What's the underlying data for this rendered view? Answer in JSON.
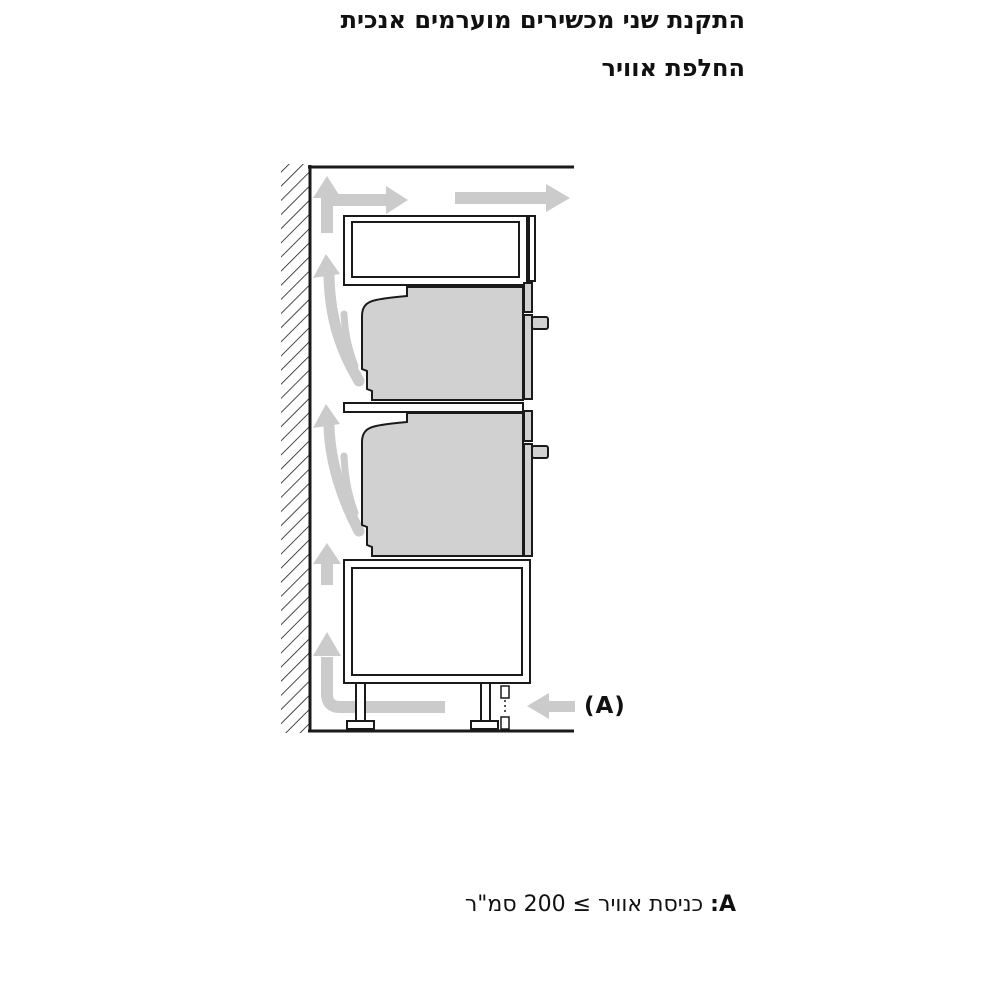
{
  "header": {
    "title": "התקנת שני מכשירים מוערמים אנכית",
    "subtitle": "החלפת אוויר"
  },
  "diagram": {
    "label_a": "(A)",
    "colors": {
      "line": "#1a1a1a",
      "appliance_fill": "#d1d1d1",
      "arrow_fill": "#cbcbcb",
      "background": "#ffffff"
    }
  },
  "footnote": {
    "prefix": "A:",
    "text": " כניסת אוויר ≥ 200 סמ\"ר"
  }
}
